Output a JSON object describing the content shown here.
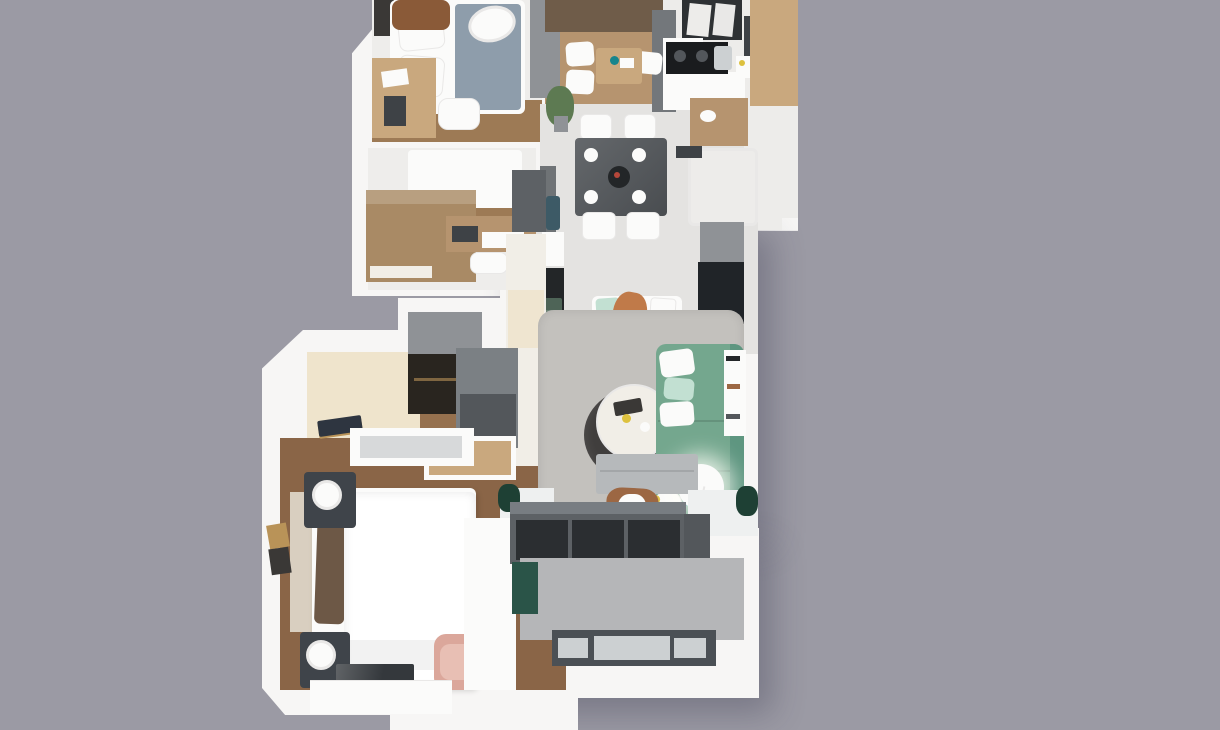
{
  "scene": {
    "type": "3d-floor-plan-render",
    "view": "top-down",
    "rooms": [
      {
        "id": "small-bedroom",
        "furniture": [
          "bed",
          "plaid-blanket",
          "pillows",
          "leather-armchair",
          "hanging-chair",
          "wall-desk",
          "side-chair"
        ]
      },
      {
        "id": "study-bedroom",
        "furniture": [
          "sofa-bed",
          "wood-wardrobe",
          "wood-desk",
          "chair"
        ]
      },
      {
        "id": "tea-lounge",
        "furniture": [
          "brown-curtains",
          "floor-cushions",
          "low-wood-table",
          "gray-closet",
          "potted-plant"
        ]
      },
      {
        "id": "kitchen",
        "furniture": [
          "window",
          "cooktop",
          "sink",
          "range-hood",
          "white-counters",
          "wood-cabinets"
        ]
      },
      {
        "id": "bathroom",
        "furniture": [
          "wood-vanity",
          "basin",
          "shower-tub"
        ]
      },
      {
        "id": "dining-hall",
        "furniture": [
          "dark-dining-table",
          "four-white-chairs",
          "plates",
          "center-bowl",
          "console",
          "figurine",
          "tall-cabinet"
        ]
      },
      {
        "id": "living-room",
        "furniture": [
          "green-sectional-sofa",
          "sofa-pillows",
          "round-coffee-table",
          "dark-round-rug",
          "shag-area-rug",
          "tv-bench",
          "butterfly-chair",
          "white-bench",
          "orange-throw",
          "wall-shelves",
          "floor-lamp",
          "sheer-curtains",
          "corner-plants"
        ]
      },
      {
        "id": "walk-in-closet",
        "furniture": [
          "glass-wardrobe",
          "gray-cabinets",
          "slatted-door",
          "floor-mat",
          "radiator"
        ]
      },
      {
        "id": "master-bedroom",
        "furniture": [
          "double-bed",
          "ribbed-headboard",
          "brown-pillows",
          "nightstand-with-lamp",
          "nightstand-with-lamp",
          "wall-frames",
          "pink-armchair",
          "tv",
          "white-dresser",
          "white-desk"
        ]
      },
      {
        "id": "balcony",
        "furniture": [
          "sliding-glass-door",
          "gray-tile-floor",
          "dark-railing",
          "green-towel"
        ]
      }
    ]
  },
  "palette": {
    "bg": "#9b9aa4",
    "wall": "#f7f6f5",
    "wall-shade": "#e9e8e7",
    "room": "#eeedeb",
    "tile": "#e4e3e1",
    "tile-light": "#edecea",
    "wood": "#b6946f",
    "wood-light": "#c9a87e",
    "wood-mid": "#9d7a55",
    "wood-warm": "#96714e",
    "wood-dark": "#8a6547",
    "wood-cab": "#a98a65",
    "wood-pale": "#efe4cc",
    "cream": "#f1eee7",
    "beige-door": "#efe5d0",
    "gray-cab": "#8f9296",
    "gray-unit": "#7b8084",
    "gray-front": "#53575b",
    "door-frame": "#5d6165",
    "partition": "#73777b",
    "charcoal": "#202428",
    "glass-dark": "#2b2e31",
    "closet-glass": "#29251f",
    "cooktop": "#1a1c1e",
    "window-frame": "#2e3134",
    "hood": "#3e4246",
    "rug": "#c3c1bd",
    "rug-dark": "#403e3d",
    "bench-gray": "#b6b9bb",
    "sofa": "#74a78e",
    "sofa-dark": "#5e9680",
    "sofa-foot": "#639a80",
    "mint": "#c2e0d2",
    "teal": "#17858d",
    "yellow": "#ddc13e",
    "pink": "#dba79b",
    "pink-light": "#e8bfb4",
    "leather": "#9c6743",
    "saddle": "#8a5a38",
    "curtain-brown": "#6f5c49",
    "curtain-gray1": "#eef0f0",
    "plant": "#5d7a52",
    "plant-dark": "#1e4034",
    "towel": "#2a5448",
    "blanket": "#8e9dab",
    "headboard": "#d9cfc0",
    "pillow-brown": "#6d5846",
    "beige-pillow": "#c9b29d",
    "night": "#3f444a",
    "tv": "#34383c",
    "balcony-tile": "#b5b6b8",
    "rail": "#4b5055",
    "rail-cut": "#ccd0d2",
    "bar": "#787d82",
    "white": "#fbfbfa",
    "console": "#6f7376",
    "figurine": "#3d5a66",
    "cube-dark": "#232628",
    "glass-green": "#56705f",
    "throw": "#c07a49",
    "radiator-core": "#b9bec0",
    "mat": "#2e3540",
    "gold": "#b99358",
    "frame-dark": "#3a3836"
  }
}
